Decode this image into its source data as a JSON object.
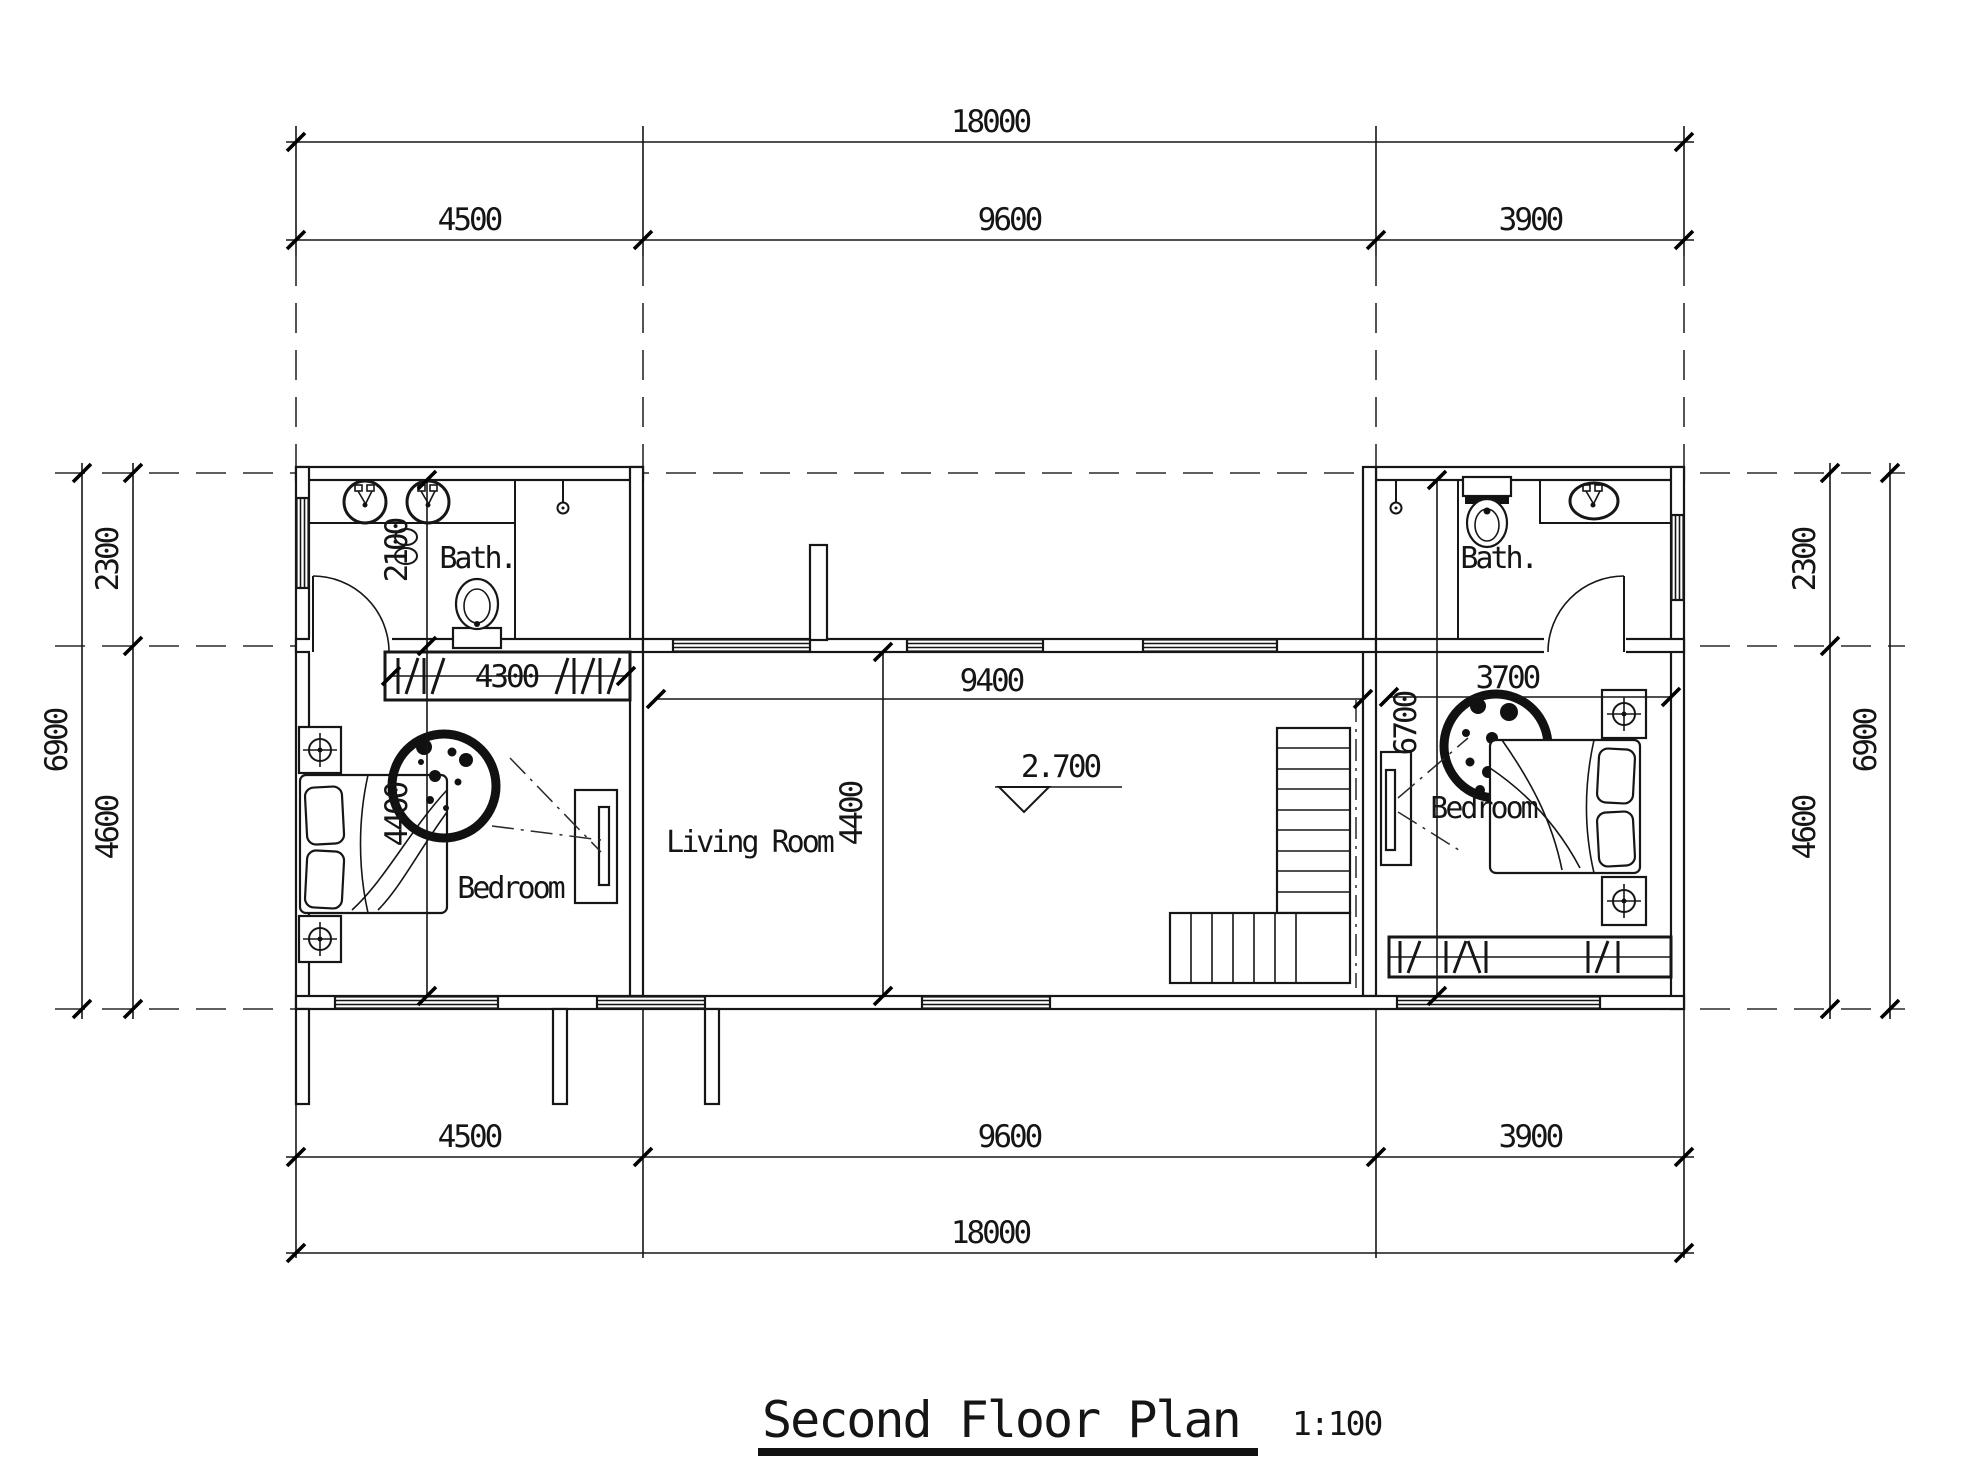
{
  "plan": {
    "title": "Second Floor Plan",
    "scale": "1:100"
  },
  "rooms": {
    "bath_left": {
      "label": "Bath."
    },
    "bath_right": {
      "label": "Bath."
    },
    "bedroom_left": {
      "label": "Bedroom"
    },
    "bedroom_right": {
      "label": "Bedroom"
    },
    "living_room": {
      "label": "Living Room"
    }
  },
  "dimensions": {
    "top": {
      "overall": "18000",
      "seg1": "4500",
      "seg2": "9600",
      "seg3": "3900"
    },
    "bottom": {
      "overall": "18000",
      "seg1": "4500",
      "seg2": "9600",
      "seg3": "3900"
    },
    "left": {
      "overall": "6900",
      "seg1": "2300",
      "seg2": "4600"
    },
    "right": {
      "overall": "6900",
      "seg1": "2300",
      "seg2": "4600"
    },
    "interior": {
      "bath_left_depth": "2100",
      "bedroom_left_width": "4300",
      "bedroom_left_depth": "4400",
      "living_width": "9400",
      "living_depth": "4400",
      "bedroom_right_width": "3700",
      "bedroom_right_depth": "6700",
      "level": "2.700"
    }
  }
}
